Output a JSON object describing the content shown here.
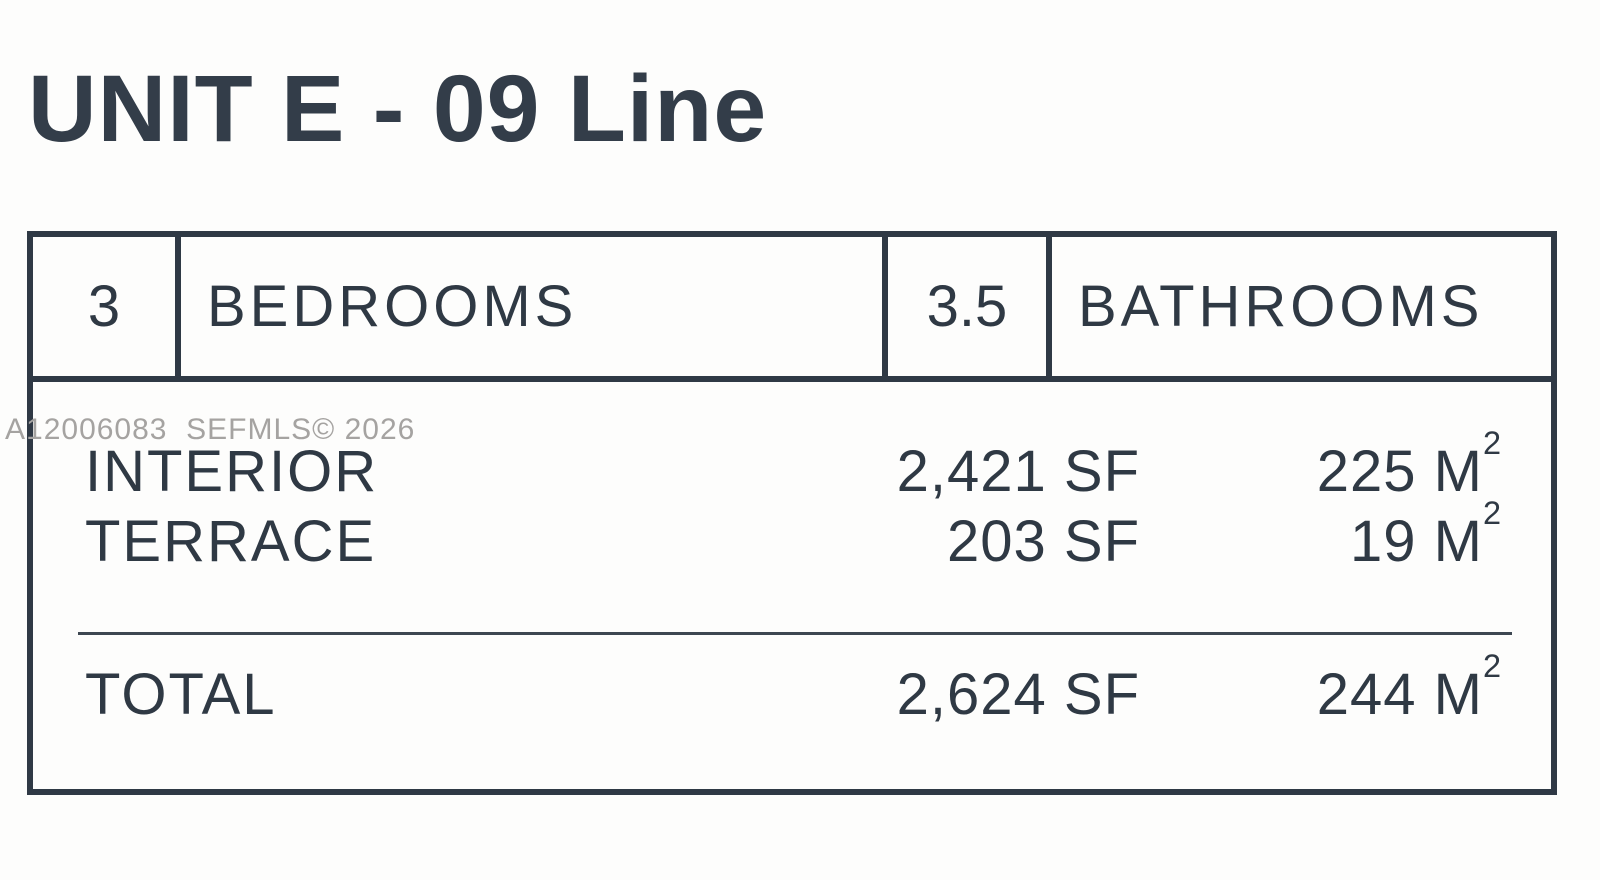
{
  "page": {
    "title": "UNIT E - 09 Line"
  },
  "watermark": "A12006083  SEFMLS© 2026",
  "summary": {
    "bedrooms_count": "3",
    "bedrooms_label": "BEDROOMS",
    "bathrooms_count": "3.5",
    "bathrooms_label": "BATHROOMS"
  },
  "areas": {
    "rows": [
      {
        "label": "INTERIOR",
        "sf": "2,421 SF",
        "m2": "225 M",
        "m2_sup": "2"
      },
      {
        "label": "TERRACE",
        "sf": "203 SF",
        "m2": "19 M",
        "m2_sup": "2"
      }
    ],
    "total": {
      "label": "TOTAL",
      "sf": "2,624 SF",
      "m2": "244 M",
      "m2_sup": "2"
    }
  },
  "colors": {
    "text": "#333d49",
    "table_border": "#2f3945",
    "divider_line": "#3d4751",
    "watermark": "#a5a3a1",
    "background": "#fdfdfc"
  }
}
